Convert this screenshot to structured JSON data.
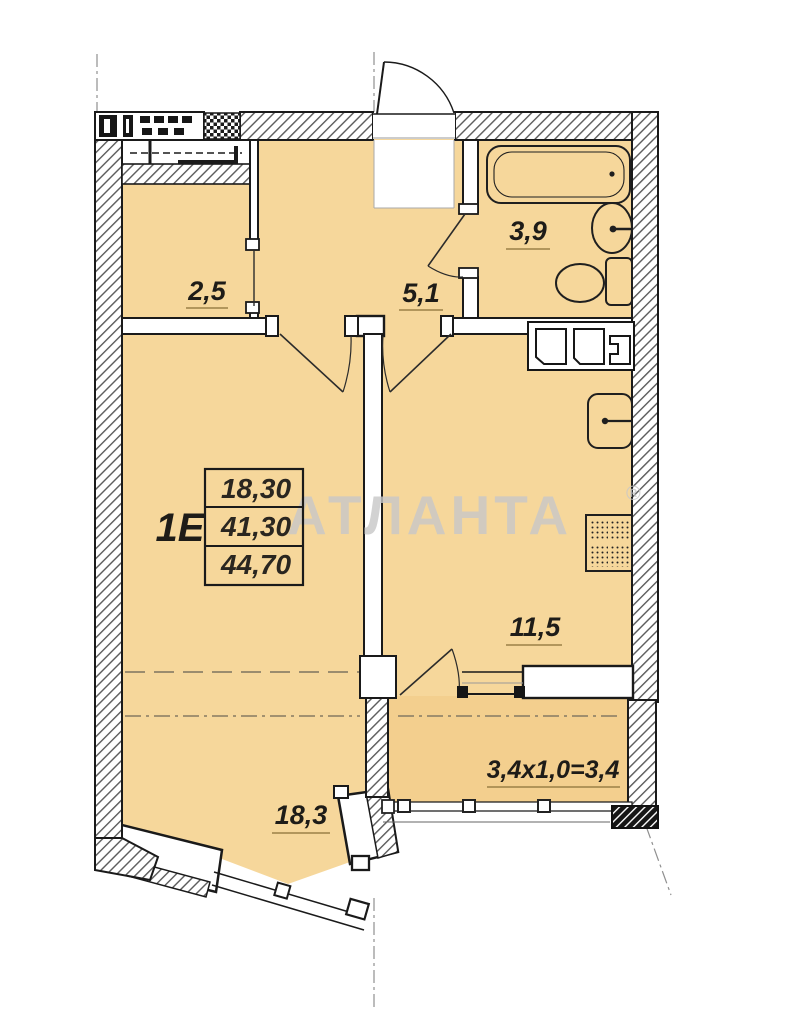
{
  "watermark": {
    "brand": "АТЛАНТА",
    "registered_mark": "®"
  },
  "unit": {
    "label": "1Е"
  },
  "area_table": {
    "rows": [
      "18,30",
      "41,30",
      "44,70"
    ]
  },
  "rooms": {
    "closet_area": "2,5",
    "hallway_area": "5,1",
    "bathroom_area": "3,9",
    "kitchen_area": "11,5",
    "living_room_area": "18,3",
    "balcony_formula": "3,4х1,0=3,4"
  },
  "colors": {
    "floor_fill": "#f6d79b",
    "balcony_fill": "#f3cf8e",
    "wall_line": "#1a1a1a",
    "watermark_gray": "#c8c8c8",
    "underline": "#9b8147"
  }
}
